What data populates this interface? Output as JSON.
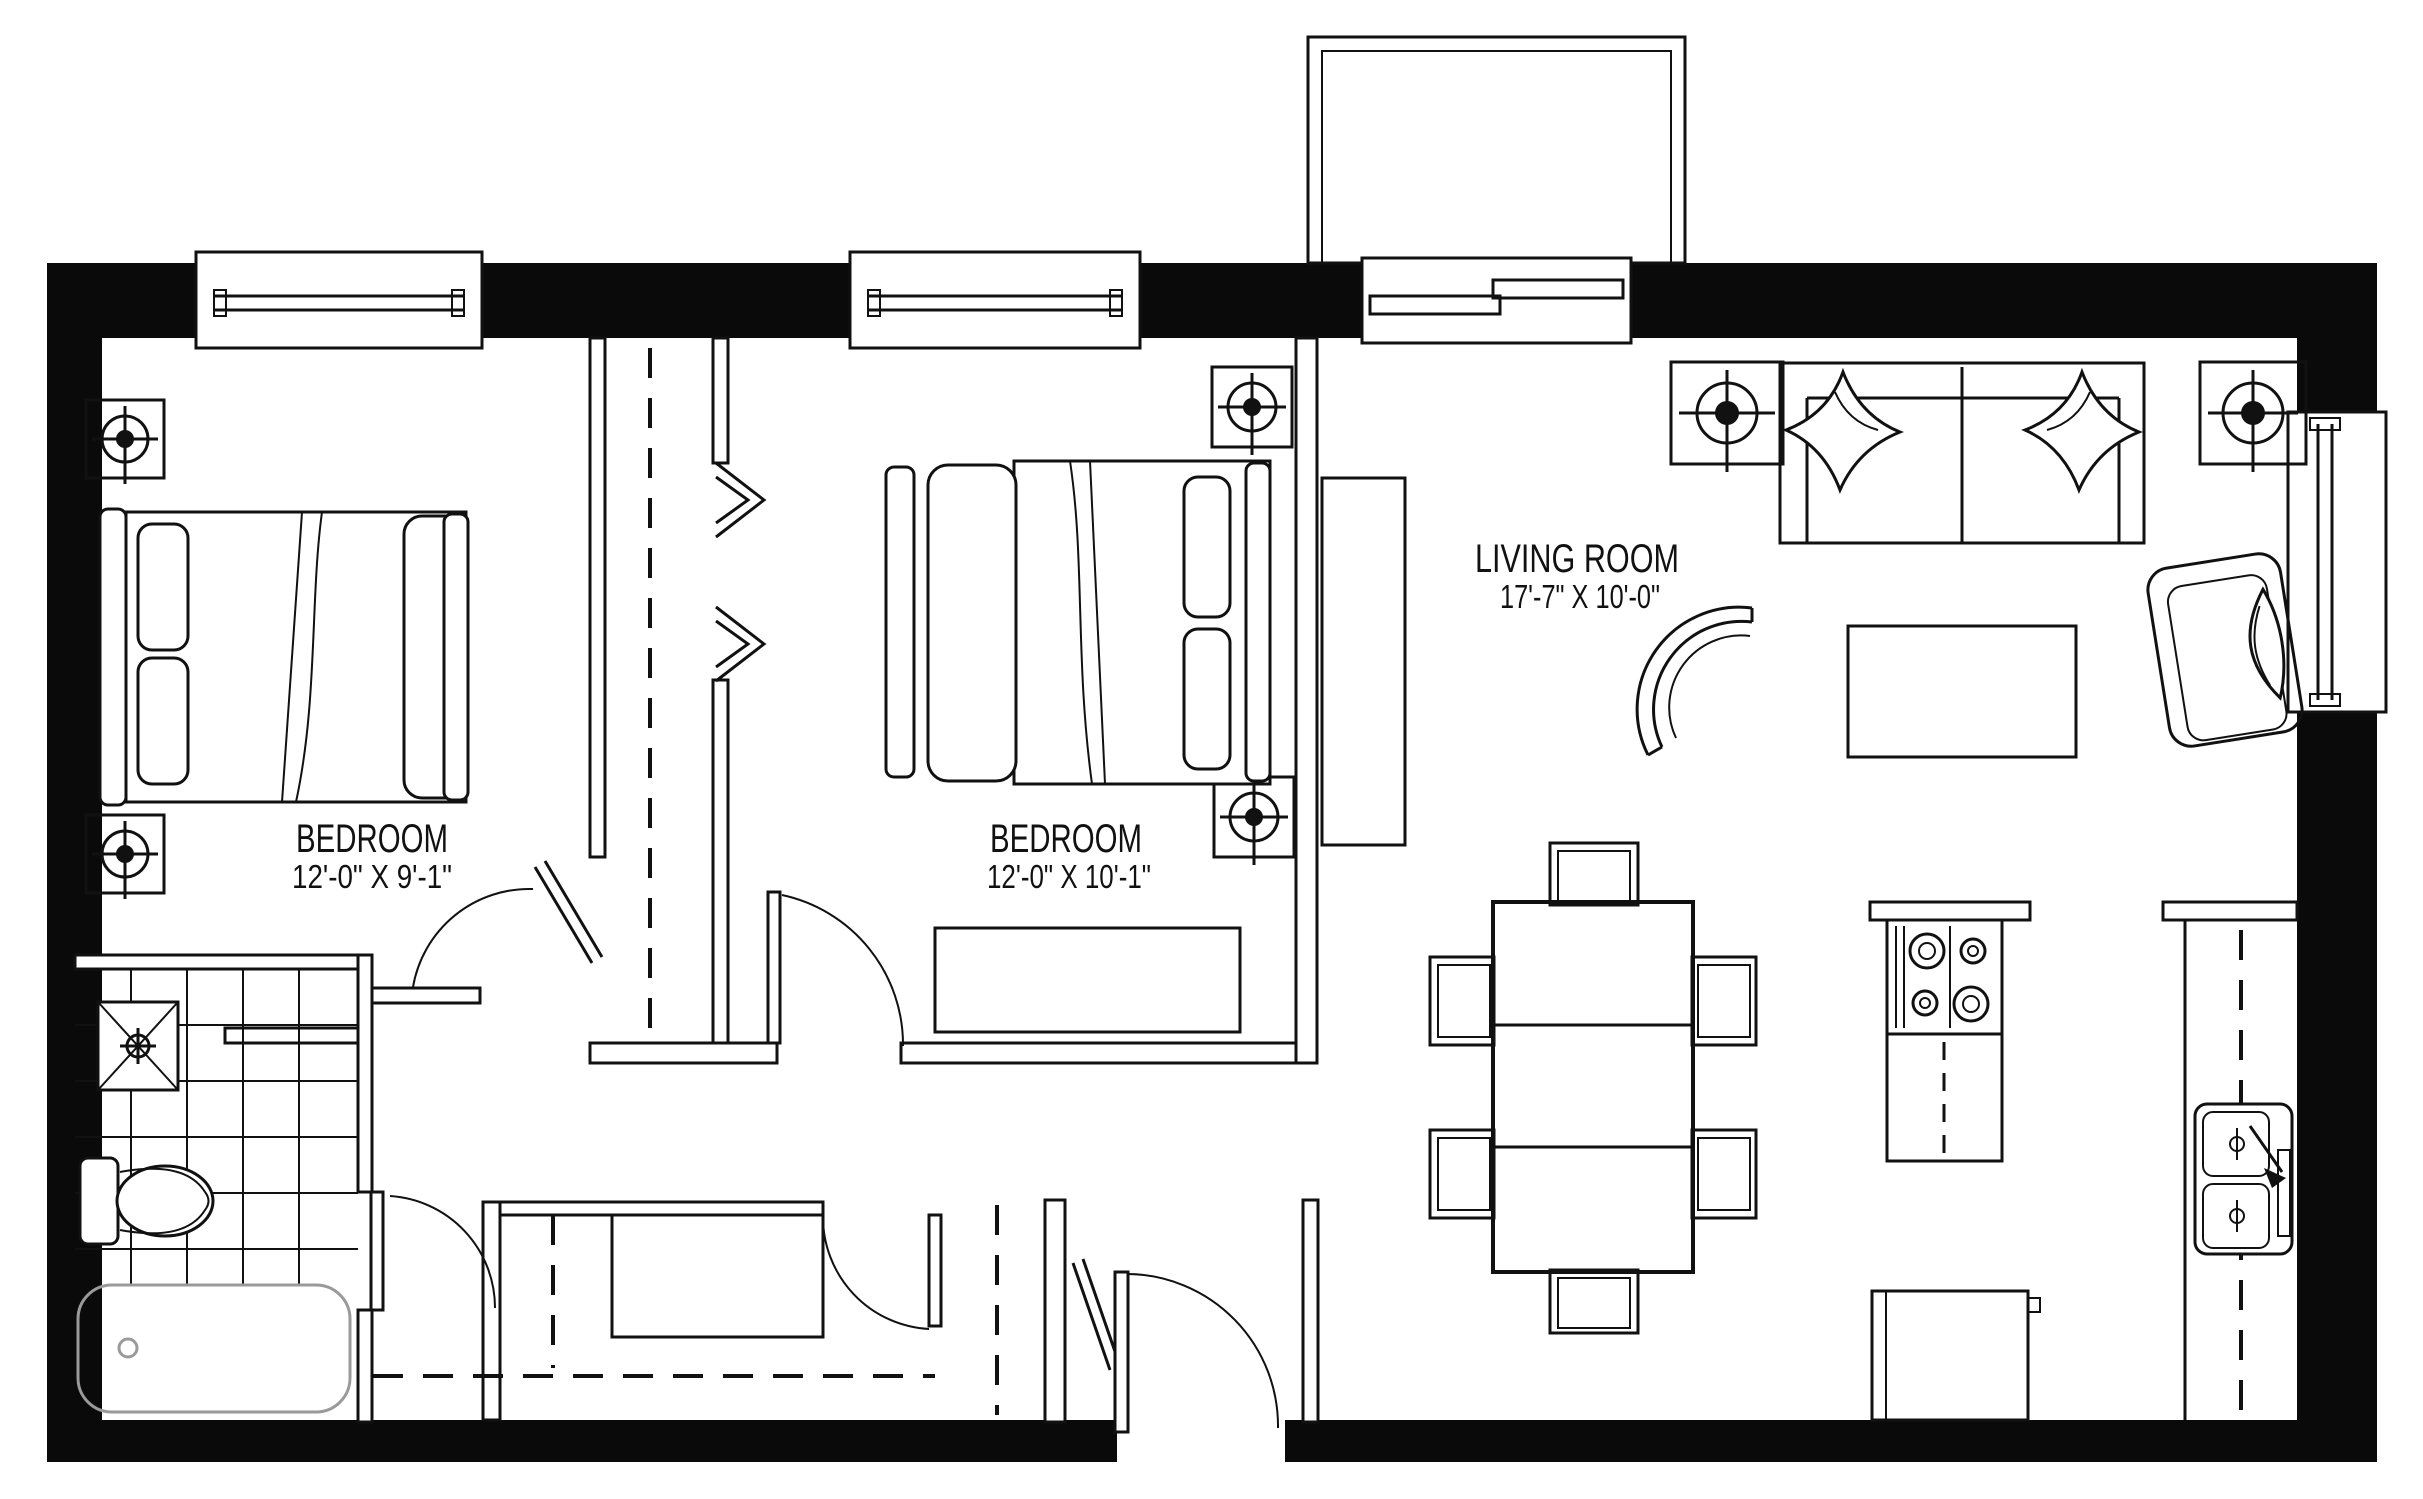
{
  "drawing_type": "apartment floor plan",
  "colors": {
    "line": "#111111",
    "wall_fill": "#0a0a0a",
    "background": "#ffffff",
    "tub_line": "#9a9a9a"
  },
  "rooms": [
    {
      "id": "bedroom-1",
      "name": "BEDROOM",
      "dimensions": "12'-0\" X 9'-1\""
    },
    {
      "id": "bedroom-2",
      "name": "BEDROOM",
      "dimensions": "12'-0\" X 10'-1\""
    },
    {
      "id": "living-room",
      "name": "LIVING ROOM",
      "dimensions": "17'-7\" X 10'-0\""
    }
  ],
  "icons": [
    "ceiling-speaker-icon",
    "shower-drain-icon",
    "stove-burner-icon",
    "sink-basin-icon",
    "door-swing-arc",
    "closet-rod-dashed",
    "window-glazing"
  ]
}
